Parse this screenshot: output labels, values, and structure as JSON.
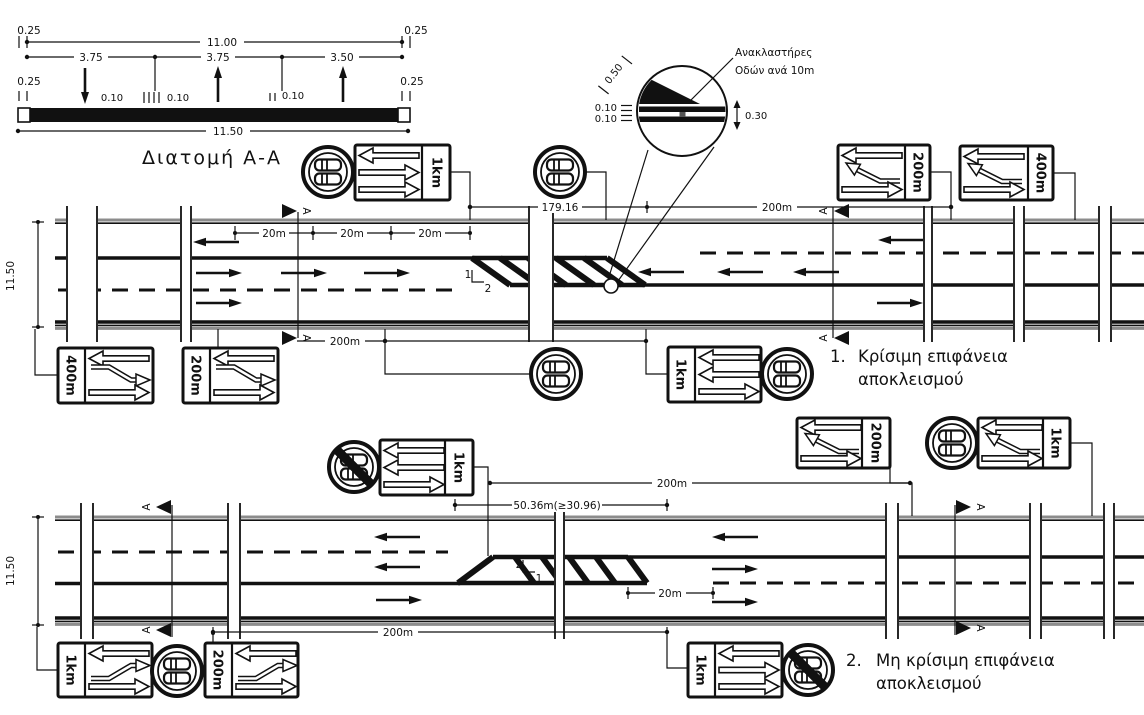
{
  "cross_section": {
    "title": "Διατομή Α-Α",
    "dim_total_top": "11.00",
    "dim_025_tl": "0.25",
    "dim_025_tr": "0.25",
    "dim_lane1": "3.75",
    "dim_lane2": "3.75",
    "dim_lane3": "3.50",
    "dim_025_bl": "0.25",
    "dim_025_br": "0.25",
    "dim_010_a": "0.10",
    "dim_010_b": "0.10",
    "dim_010_c": "0.10",
    "dim_total_bottom": "11.50"
  },
  "detail": {
    "note_line1": "Ανακλαστήρες",
    "note_line2": "Οδών ανά 10m",
    "dim_050": "0.50",
    "dim_010_top": "0.10",
    "dim_010_bottom": "0.10",
    "dim_030": "0.30"
  },
  "road1": {
    "width_dim": "11.50",
    "section_letter": "A",
    "dim_20m": "20m",
    "dim_179": "179.16",
    "dim_200_top": "200m",
    "dim_200_bottom": "200m",
    "slope_num": "1",
    "slope_den": "2",
    "caption_num": "1.",
    "caption_line1": "Κρίσιμη επιφάνεια",
    "caption_line2": "αποκλεισμού",
    "signs": {
      "top_left_panel": "1km",
      "top_right_1_panel": "200m",
      "top_right_2_panel": "400m",
      "bottom_left_1_panel": "400m",
      "bottom_left_2_panel": "200m",
      "bottom_mid_panel": "1km"
    }
  },
  "road2": {
    "width_dim": "11.50",
    "section_letter": "A",
    "dim_50": "50.36m(≥30.96)",
    "dim_200_top": "200m",
    "dim_20m": "20m",
    "dim_200_bottom": "200m",
    "slope_num": "2",
    "slope_den": "1",
    "caption_num": "2.",
    "caption_line1": "Μη κρίσιμη επιφάνεια",
    "caption_line2": "αποκλεισμού",
    "signs": {
      "top_left_panel": "1km",
      "top_right_1_panel": "200m",
      "top_right_2_panel": "1km",
      "bottom_left_1_panel": "1km",
      "bottom_left_2_panel": "200m",
      "bottom_mid_panel": "1km"
    }
  }
}
